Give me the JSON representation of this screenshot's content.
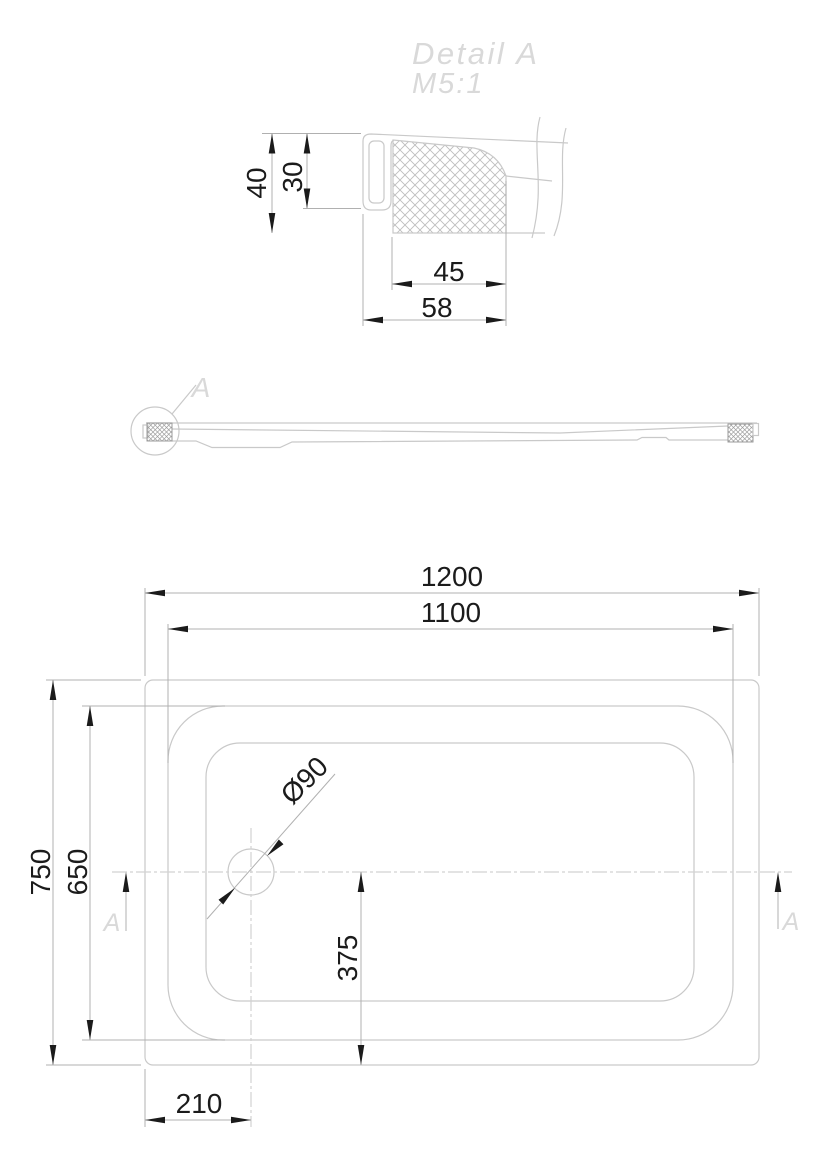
{
  "colors": {
    "background": "#ffffff",
    "line_light": "#c9c9c9",
    "centerline": "#d2d2d2",
    "dim_line": "#b0b0b0",
    "dim": "#1b1b1b",
    "hatch_detail": "#bdbdbd",
    "hatch_side": "#9e9e9e",
    "ghost_text": "#d9d9d9"
  },
  "detail_view": {
    "title": "Detail A",
    "scale": "M5:1",
    "dim_40": "40",
    "dim_30": "30",
    "dim_45": "45",
    "dim_58": "58"
  },
  "side_view": {
    "detail_label": "A"
  },
  "plan_view": {
    "dim_width_outer": "1200",
    "dim_width_inner": "1100",
    "dim_height_outer": "750",
    "dim_height_inner": "650",
    "dim_drain_y": "375",
    "dim_drain_x": "210",
    "dim_drain_diameter": "Ø90",
    "section_label_left": "A",
    "section_label_right": "A"
  }
}
